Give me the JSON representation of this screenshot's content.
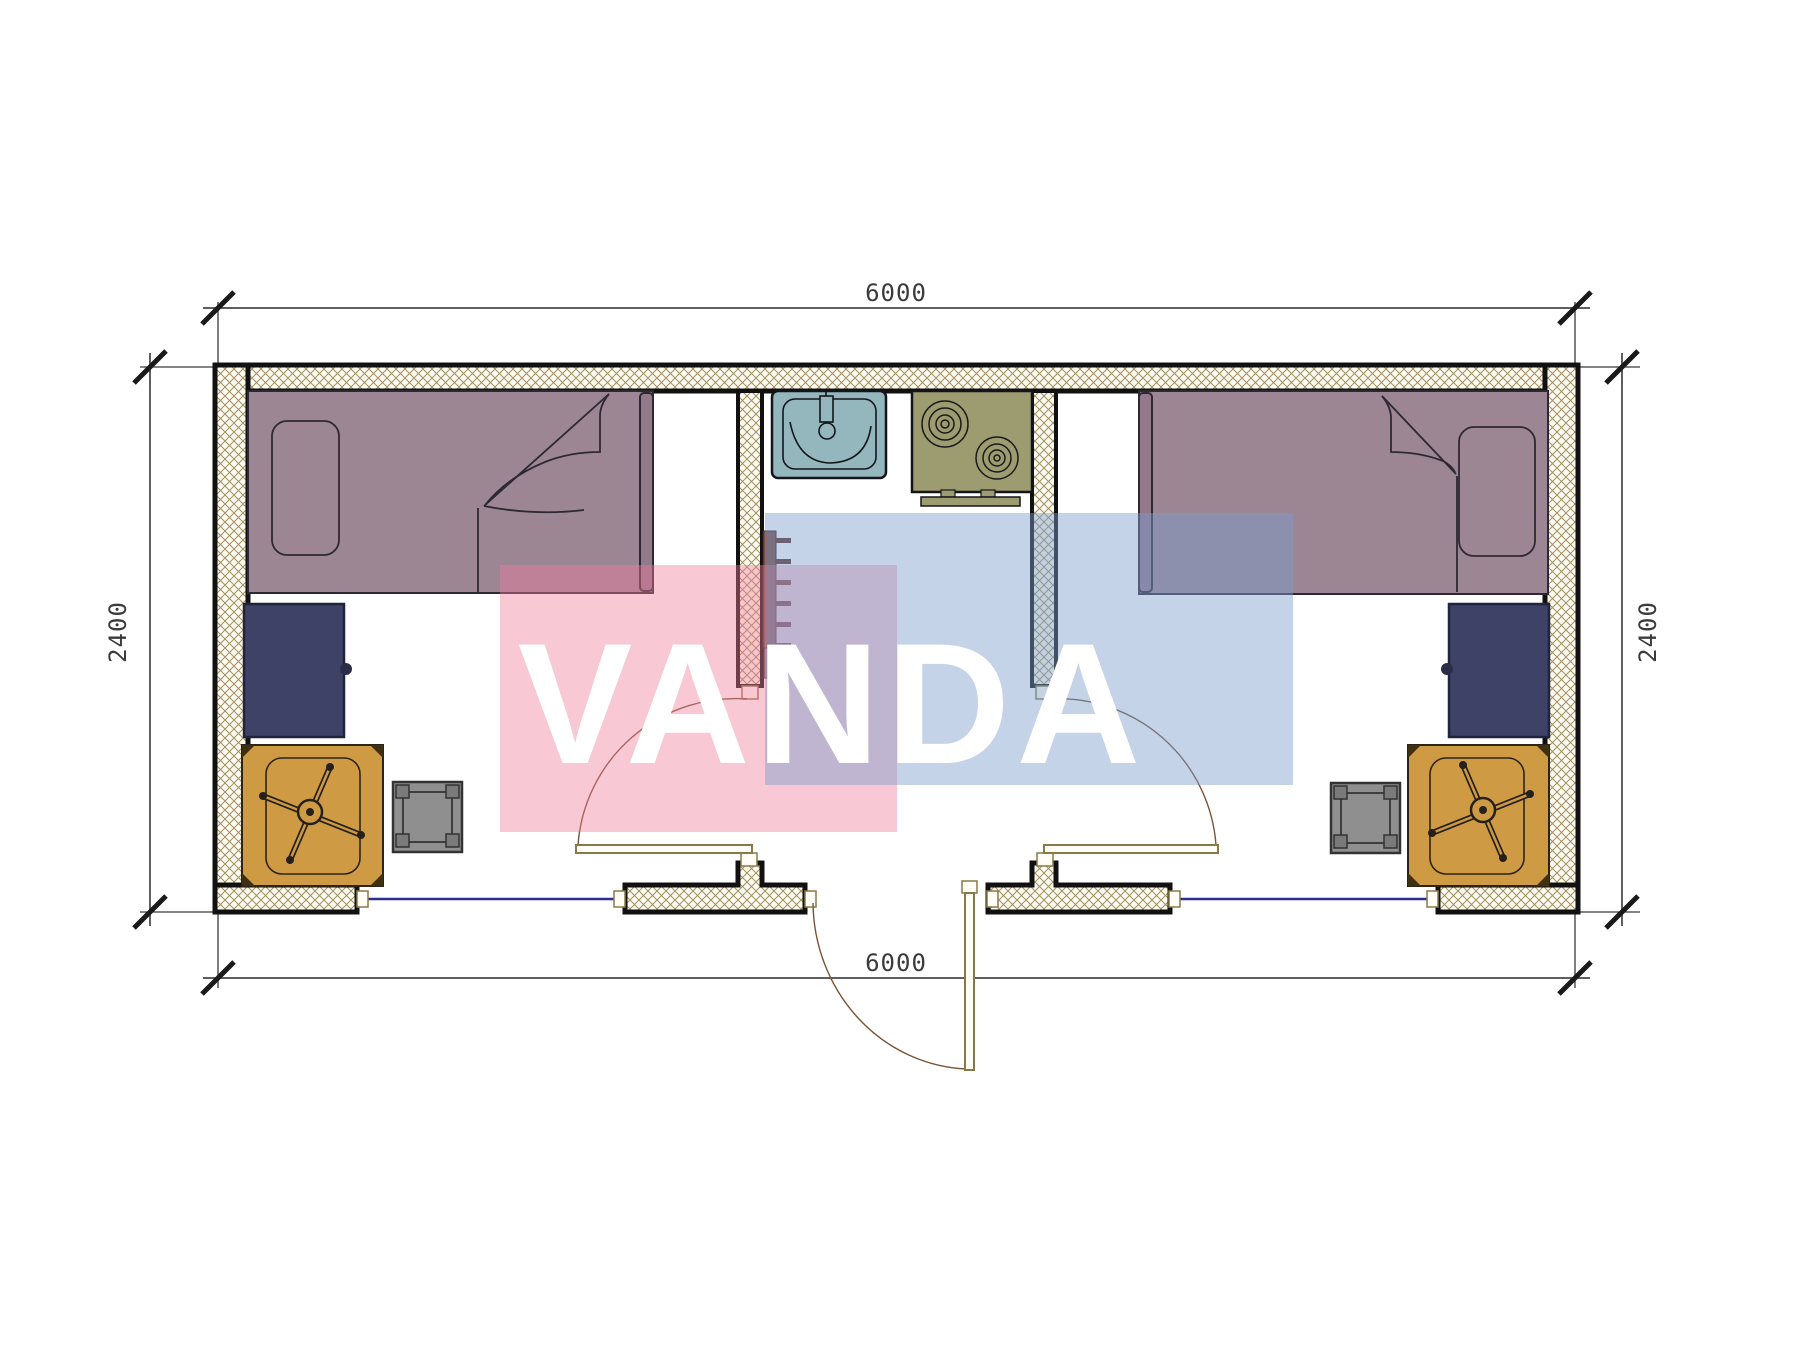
{
  "drawing": {
    "type": "architectural-floor-plan",
    "subject": "modular container cabin 6000 x 2400 with two bedrooms and central kitchen entry"
  },
  "dimensions": {
    "top": "6000",
    "bottom": "6000",
    "left": "2400",
    "right": "2400",
    "units": "mm"
  },
  "watermark": {
    "text": "VANDA",
    "red_block_color": "#ee7d9b",
    "blue_block_color": "#7d9dcd",
    "text_color": "#ffffff"
  },
  "colors": {
    "wall_outline": "#111111",
    "wall_hatch_line": "#a2925e",
    "wall_hatch_bg": "#fcfaf2",
    "bed_fill": "#9c8694",
    "bed_footboard": "#93798a",
    "cabinet_fill": "#3e4266",
    "desk_fill": "#cf9a44",
    "stool_fill": "#8f8f8f",
    "sink_fill": "#93b7bd",
    "stove_fill": "#9c9c70",
    "ladder_rail": "#7b4a42",
    "window_line": "#2b2f8e",
    "door_leaf_stroke": "#8a7948",
    "door_arc": "#7a5535",
    "dimension_line": "#2a2a2a"
  },
  "elements": {
    "left_room": [
      "single-bed",
      "pillow",
      "blanket-fold",
      "wardrobe-cabinet",
      "desk",
      "office-chair",
      "stool"
    ],
    "center_zone": [
      "wash-basin",
      "two-burner-stove",
      "wall-ladder"
    ],
    "right_room": [
      "single-bed",
      "pillow",
      "blanket-fold",
      "wardrobe-cabinet",
      "desk",
      "office-chair",
      "stool"
    ],
    "openings": [
      "left-room-door",
      "right-room-door",
      "entry-door",
      "left-window",
      "right-window"
    ]
  }
}
